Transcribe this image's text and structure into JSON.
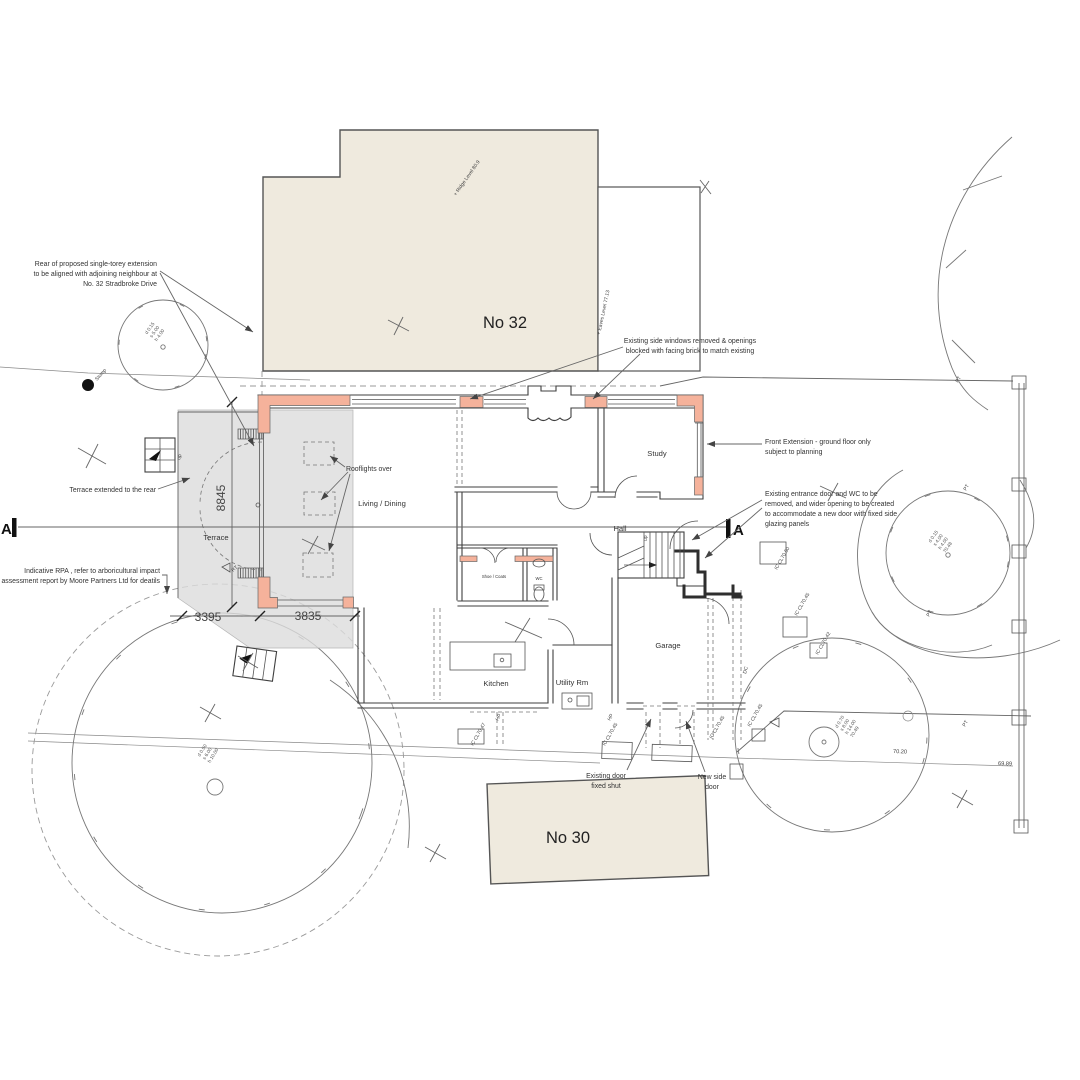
{
  "colors": {
    "new_wall_salmon": "#f5b29b",
    "building_beige": "#efeade",
    "extension_shade": "#dcdcdc",
    "line_dark": "#3f3f3f"
  },
  "buildings": {
    "no32": {
      "label": "No 32",
      "ridge": "+ Ridge Level  80.9",
      "eaves": "+ Eaves Level  77.13"
    },
    "no30": {
      "label": "No 30"
    }
  },
  "rooms": {
    "terrace": "Terrace",
    "living": "Living / Dining",
    "study": "Study",
    "hall": "Hall",
    "kitchen": "Kitchen",
    "utility": "Utility Rm",
    "garage": "Garage",
    "wc": "WC",
    "store": "Shoe / Coats"
  },
  "labels": {
    "rooflights": "Rooflights over",
    "up": "up",
    "stump": "Stump",
    "pt": "PT",
    "dc": "DC",
    "hp": "HP",
    "rt": "RT",
    "section": "A"
  },
  "dimensions": {
    "depth": "8845",
    "w1": "3395",
    "w2": "3835"
  },
  "levels": {
    "drive1": "70.20",
    "drive2": "69.89"
  },
  "chambers": {
    "ic1": "IC CL70.50",
    "ic2": "IC CL70.45",
    "ic3": "IC CL70.42",
    "ic4": "IC CL70.45",
    "ic5": "IC CL70.47",
    "ic6": "IC CL70.45",
    "ic7": "IC CL70.45"
  },
  "trees": {
    "t1": [
      "d 0.15",
      "s 5.00",
      "h 4.00"
    ],
    "t2": [
      "d 0.15",
      "s 4.00",
      "h 4.00",
      "70.48"
    ],
    "t3": [
      "d 0.70",
      "s 8.00",
      "h 14.00",
      "70.49"
    ],
    "t4": [
      "d 0.50",
      "s 6.00",
      "h 10.00"
    ]
  },
  "annotations": {
    "rear_extension": [
      "Rear of proposed single-torey extension",
      "to be aligned with adjoining neighbour at",
      "No. 32 Stradbroke Drive"
    ],
    "terrace_extended": "Terrace extended to the rear",
    "rpa": [
      "Indicative RPA , refer to arboricultural impact",
      "assessment report by Moore Partners Ltd for deatils"
    ],
    "side_windows": [
      "Existing side windows removed & openings",
      "blocked with facing brick to match existing"
    ],
    "front_extension": [
      "Front Extension - ground floor only",
      "subject to planning"
    ],
    "entrance": [
      "Existing entrance door and WC to be",
      "removed, and wider opening to be created",
      "to accommodate a new door with fixed side",
      "glazing panels"
    ],
    "door_fixed": [
      "Existing door",
      "fixed shut"
    ],
    "side_door": [
      "New side",
      "door"
    ]
  }
}
